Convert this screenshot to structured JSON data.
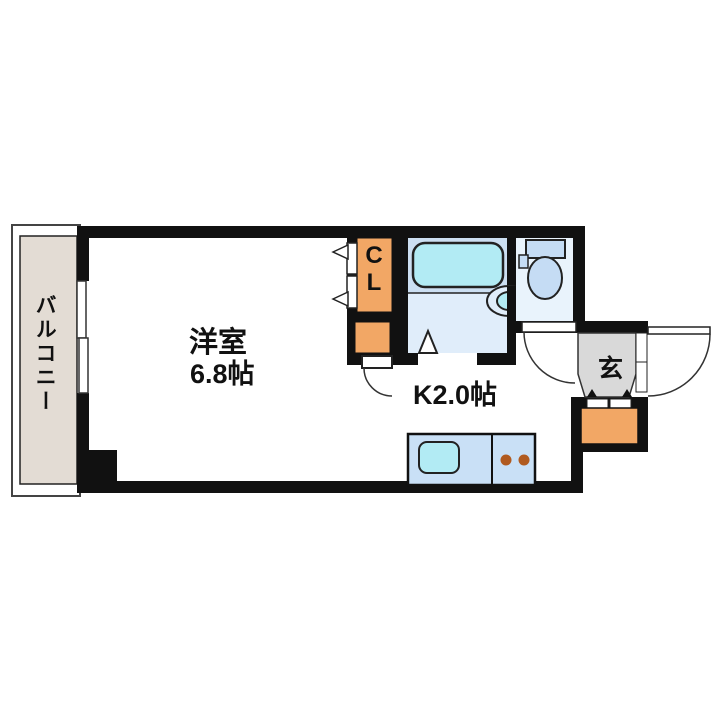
{
  "floorplan": {
    "labels": {
      "balcony": "バルコニー",
      "living_room": "洋室",
      "living_room_size": "6.8帖",
      "kitchen": "K2.0帖",
      "closet": "CL",
      "entrance": "玄"
    },
    "colors": {
      "wall": "#111111",
      "balcony_floor": "#e3dcd4",
      "closet_fill": "#f2a765",
      "bath_upper": "#ccdff2",
      "bath_floor": "#e0edfa",
      "bathtub": "#b2ebf4",
      "toilet_room": "#e9f3fc",
      "fixture_blue": "#c5dcf4",
      "entrance_floor": "#d9d9d9",
      "counter": "#c9e0f6",
      "sink": "#b2ebf4",
      "burner": "#b05a1f",
      "outline": "#222222"
    }
  }
}
